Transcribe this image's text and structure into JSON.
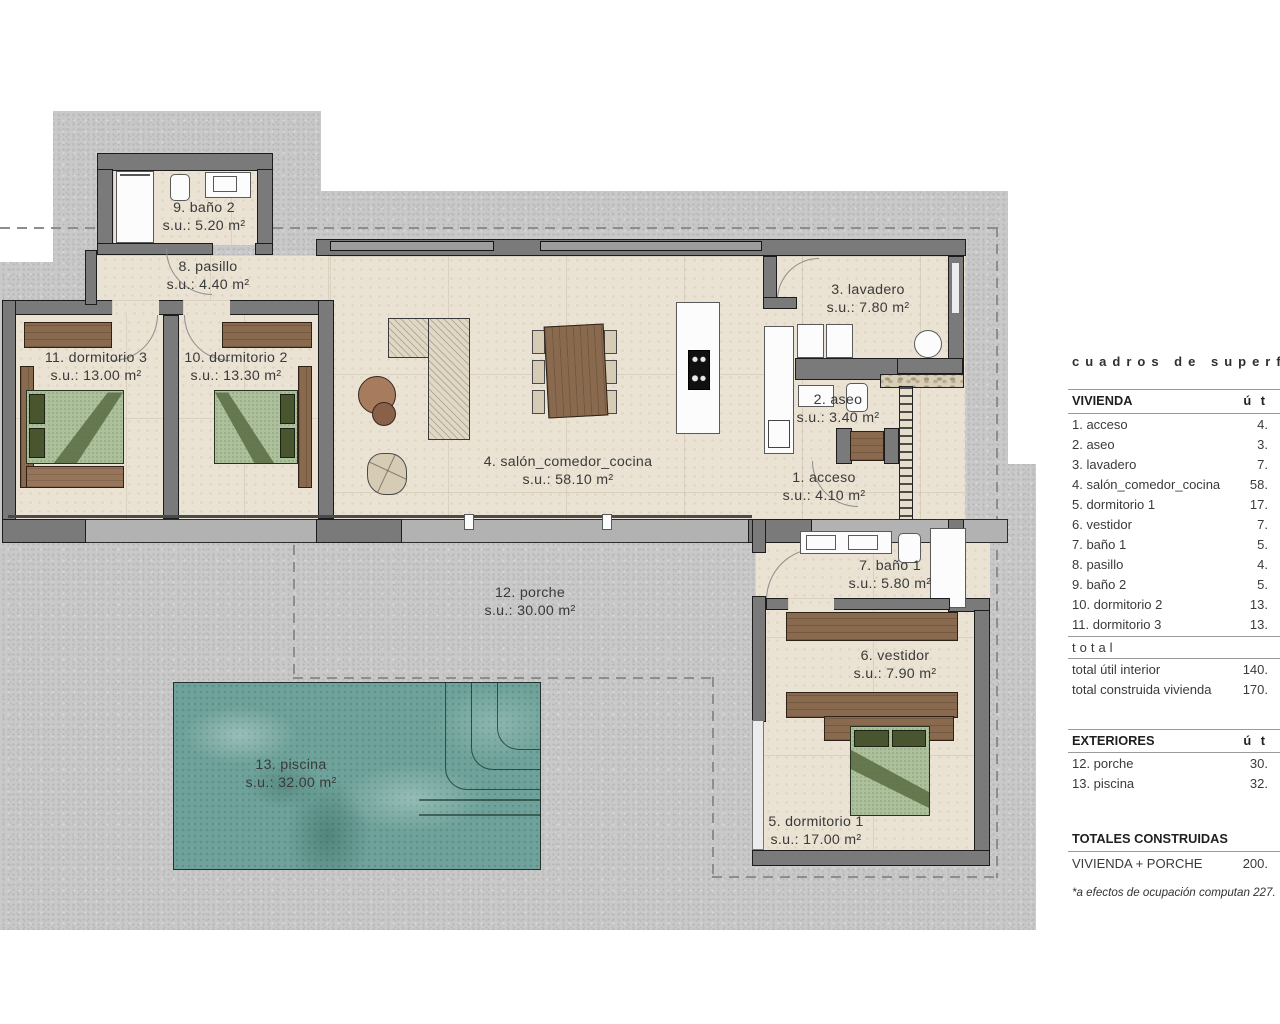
{
  "plan": {
    "rooms": [
      {
        "label": "1. acceso",
        "area": "s.u.: 4.10 m²"
      },
      {
        "label": "2. aseo",
        "area": "s.u.: 3.40 m²"
      },
      {
        "label": "3. lavadero",
        "area": "s.u.: 7.80 m²"
      },
      {
        "label": "4. salón_comedor_cocina",
        "area": "s.u.: 58.10 m²"
      },
      {
        "label": "5. dormitorio 1",
        "area": "s.u.: 17.00 m²"
      },
      {
        "label": "6. vestidor",
        "area": "s.u.: 7.90 m²"
      },
      {
        "label": "7. baño 1",
        "area": "s.u.: 5.80 m²"
      },
      {
        "label": "8. pasillo",
        "area": "s.u.: 4.40 m²"
      },
      {
        "label": "9. baño 2",
        "area": "s.u.: 5.20 m²"
      },
      {
        "label": "10. dormitorio 2",
        "area": "s.u.: 13.30 m²"
      },
      {
        "label": "11. dormitorio 3",
        "area": "s.u.: 13.00 m²"
      },
      {
        "label": "12. porche",
        "area": "s.u.: 30.00 m²"
      },
      {
        "label": "13. piscina",
        "area": "s.u.: 32.00 m²"
      }
    ]
  },
  "summary_table": {
    "title": "cuadros de superfi",
    "vivienda": {
      "header": "VIVIENDA",
      "col_header": "ú t",
      "rows": [
        {
          "label": "1. acceso",
          "value": "4."
        },
        {
          "label": "2. aseo",
          "value": "3."
        },
        {
          "label": "3. lavadero",
          "value": "7."
        },
        {
          "label": "4. salón_comedor_cocina",
          "value": "58."
        },
        {
          "label": "5. dormitorio 1",
          "value": "17."
        },
        {
          "label": "6. vestidor",
          "value": "7."
        },
        {
          "label": "7. baño 1",
          "value": "5."
        },
        {
          "label": "8. pasillo",
          "value": "4."
        },
        {
          "label": "9. baño 2",
          "value": "5."
        },
        {
          "label": "10. dormitorio 2",
          "value": "13."
        },
        {
          "label": "11. dormitorio 3",
          "value": "13."
        }
      ],
      "total_label": "total",
      "totals": [
        {
          "label": "total útil interior",
          "value": "140."
        },
        {
          "label": "total construida vivienda",
          "value": "170."
        }
      ]
    },
    "exteriores": {
      "header": "EXTERIORES",
      "col_header": "ú t",
      "rows": [
        {
          "label": "12. porche",
          "value": "30."
        },
        {
          "label": "13. piscina",
          "value": "32."
        }
      ]
    },
    "totales": {
      "header": "TOTALES CONSTRUIDAS",
      "rows": [
        {
          "label": "VIVIENDA + PORCHE",
          "value": "200."
        }
      ]
    },
    "footnote": "*a efectos de ocupación computan 227."
  },
  "colors": {
    "wall": "#7a7a7a",
    "floor": "#eae2d3",
    "terrain": "#c9c9c9",
    "pool": "#6fa29a",
    "wood": "#8a6a4e",
    "bed": "#adc09c"
  }
}
